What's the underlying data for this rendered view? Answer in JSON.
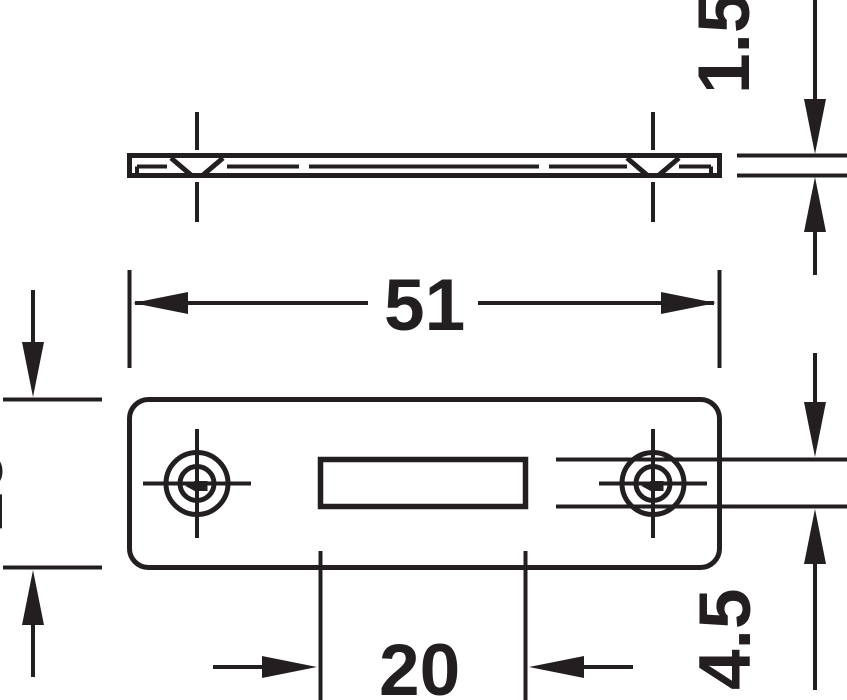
{
  "drawing": {
    "ink": "#231f20",
    "background": "#ffffff",
    "dimensions": {
      "plate_thickness": "1.5",
      "plate_length": "51",
      "plate_height": "16",
      "slot_height": "4.5",
      "slot_width": "20"
    }
  }
}
